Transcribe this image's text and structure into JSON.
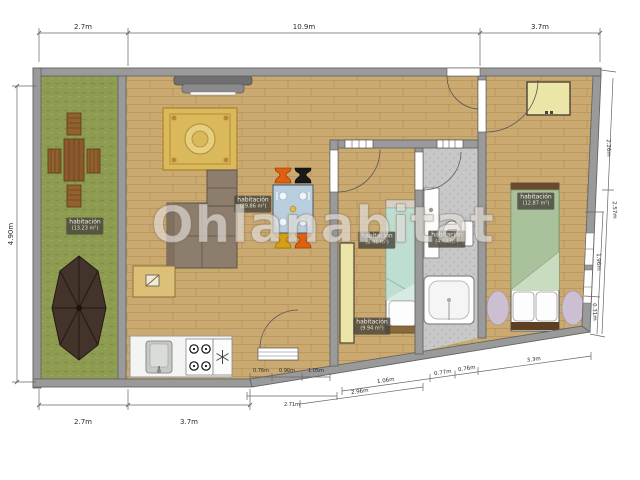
{
  "watermark": {
    "text": "Ohlanabitat"
  },
  "dims": {
    "top": [
      "2.7m",
      "10.9m",
      "3.7m"
    ],
    "left_height": "4.90m",
    "bottom": [
      "2.7m",
      "3.7m"
    ],
    "kitchen_segs": [
      "0.76m",
      "0.90m",
      "1.05m"
    ],
    "kitchen_total": "2.71m",
    "slant_outer": "2.96m",
    "slant_segs": [
      "1.06m",
      "0.77m",
      "0.76m",
      "3.3m"
    ],
    "right_outer": [
      "2.26m",
      "2.57m"
    ],
    "right_inner": [
      "1.96m",
      "0.31m"
    ]
  },
  "rooms": [
    {
      "label": "habitación",
      "area": "(13.23 m²)"
    },
    {
      "label": "habitación",
      "area": "(29.86 m²)"
    },
    {
      "label": "habitación",
      "area": "(8.41 m²)"
    },
    {
      "label": "habitación",
      "area": "(9.94 m²)"
    },
    {
      "label": "habitación",
      "area": "(4.43 m²)"
    },
    {
      "label": "habitación",
      "area": "(12.87 m²)"
    }
  ],
  "colors": {
    "wall": "#9a9a9a",
    "wood_floor": "#cbaa72",
    "grass": "#8e9c52",
    "bath_tile": "#c8c8c8",
    "stool_orange": "#e06010",
    "stool_black": "#1a1a1a",
    "stool_yellow": "#d8a010",
    "wardrobe_yellow": "#ece5a8",
    "blanket_green": "#a9c29b",
    "blanket_mint": "#bfded2"
  }
}
